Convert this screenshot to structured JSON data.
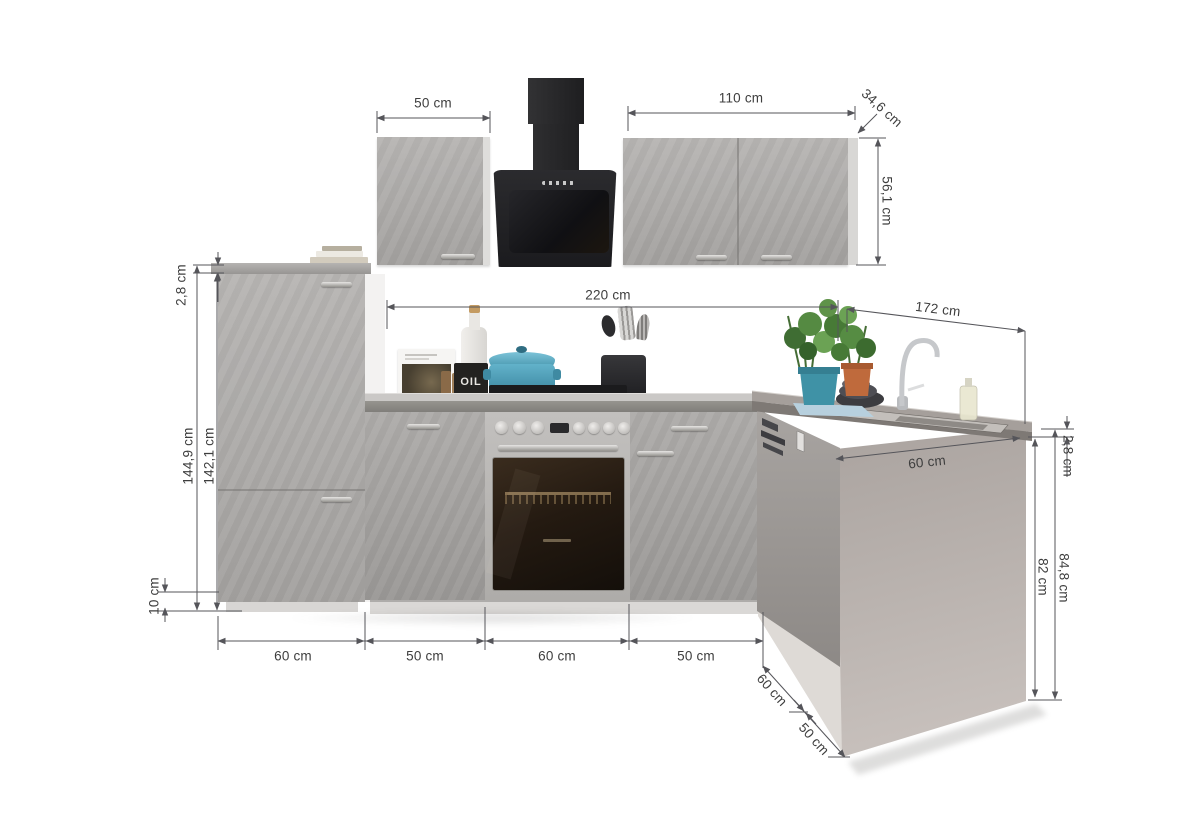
{
  "scene": {
    "description": "L-shaped fitted kitchen with concrete-look fronts, dimension drawing",
    "objects": [
      "tall-cabinet",
      "wall-cabinet-left",
      "cooker-hood",
      "wall-cabinet-right",
      "base-cabinet-left",
      "built-in-oven",
      "ceramic-hob",
      "base-cabinet-right",
      "corner-dishwasher-front",
      "sink-worktop",
      "right-end-panel",
      "cookbook",
      "oil-bottle",
      "spice-jars",
      "teal-casserole",
      "utensil-pot",
      "herb-pots",
      "chrome-faucet",
      "bowl-stack",
      "kitchen-towel",
      "dish-soap-bottle",
      "books-stack"
    ],
    "colors": {
      "cabinet_concrete": "#adaaa8",
      "hood_black": "#242427",
      "worktop_gray": "#8e8c8a",
      "end_panel_beige": "#b5aeaa",
      "accent_teal": "#4fa3bd",
      "terracotta_pot": "#bf6a3c",
      "dimension_line": "#55555a",
      "dimension_text": "#3e3e3e"
    }
  },
  "labels": {
    "oil_bottle": "OIL"
  },
  "dimensions": {
    "wall_left_width": "50 cm",
    "wall_right_width": "110 cm",
    "wall_depth": "34,6 cm",
    "wall_height": "56,1 cm",
    "tall_worktop_thickness": "2,8 cm",
    "tall_total_height": "144,9 cm",
    "tall_body_height": "142,1 cm",
    "plinth_height": "10 cm",
    "left_run_length": "220 cm",
    "right_run_length": "172 cm",
    "seg_tall_width": "60 cm",
    "seg_base1_width": "50 cm",
    "seg_oven_width": "60 cm",
    "seg_base2_width": "50 cm",
    "corner_depth": "60 cm",
    "right_front_width": "50 cm",
    "sink_cabinet_width": "60 cm",
    "right_worktop_thickness": "2,8 cm",
    "worktop_total_height": "84,8 cm",
    "base_unit_height": "82 cm"
  }
}
